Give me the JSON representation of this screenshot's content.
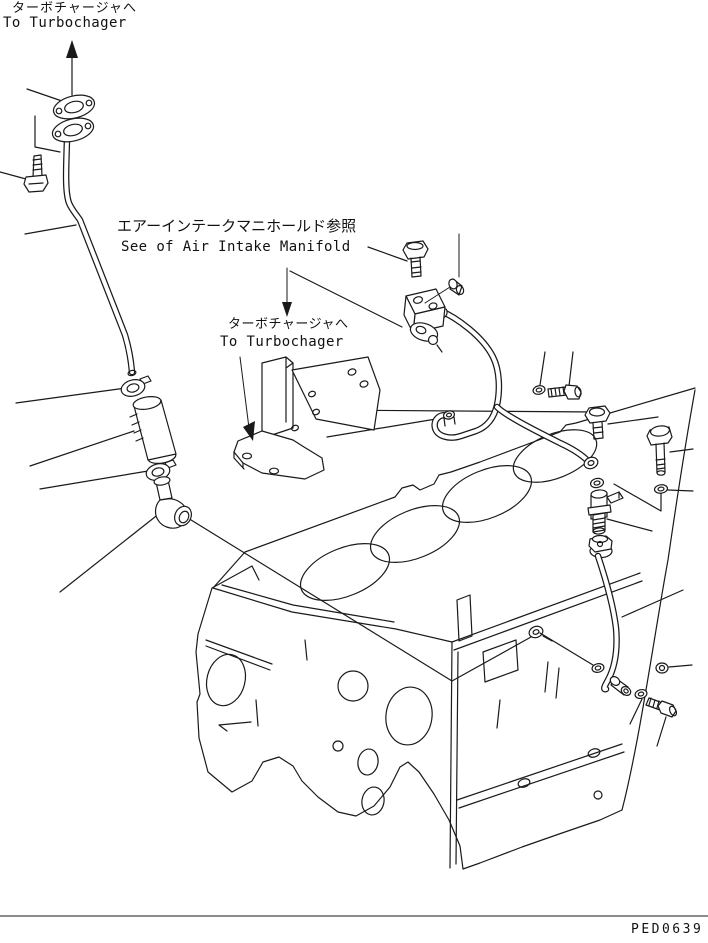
{
  "page": {
    "background": "#ffffff",
    "line_color": "#1a1a1a"
  },
  "labels": {
    "turbo_top_jp": "ターボチャージャへ",
    "turbo_top_en": "To Turbochager",
    "intake_ref_jp": "エアーインテークマニホールド参照",
    "intake_ref_en": "See of Air Intake Manifold",
    "turbo_mid_jp": "ターボチャージャへ",
    "turbo_mid_en": "To Turbochager",
    "drawing_code": "PED0639"
  },
  "diagram": {
    "type": "exploded-parts-line-drawing",
    "subject": "engine cylinder block with turbocharger oil piping",
    "parts": [
      "flange-gasket-upper",
      "flange-gasket-lower",
      "hex-bolt-left",
      "turbo-oil-drain-pipe",
      "hose-clamp-upper",
      "oil-return-hose",
      "hose-clamp-lower",
      "elbow-fitting",
      "manifold-bracket",
      "mounting-bolt",
      "plug",
      "oil-valve-block",
      "small-gasket",
      "oil-supply-pipe-upper",
      "washer",
      "short-bolt",
      "hex-bolt-right",
      "washer",
      "union-fitting",
      "long-hex-bolt",
      "washer",
      "nut-fitting",
      "oil-supply-pipe-lower",
      "banjo-fitting",
      "washer",
      "angled-bolt",
      "cylinder-block"
    ]
  }
}
